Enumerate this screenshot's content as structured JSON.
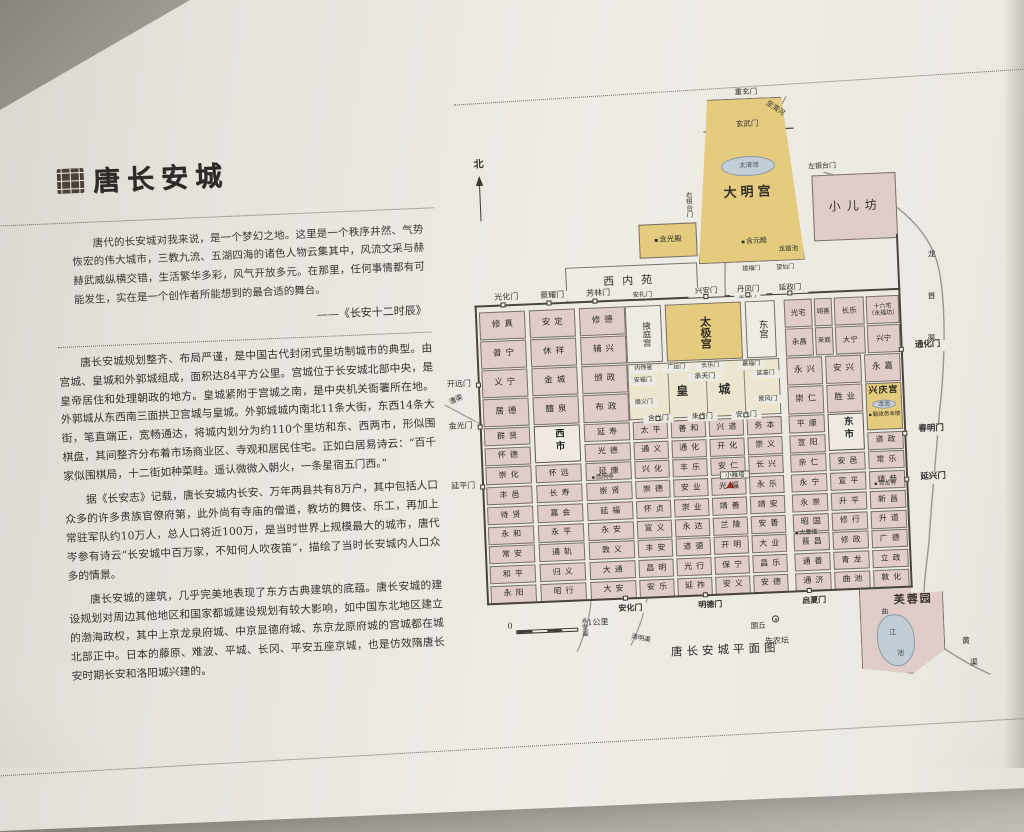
{
  "panel": {
    "title": "唐长安城",
    "quote": "唐代的长安城对我来说，是一个梦幻之地。这里是一个秩序井然、气势恢宏的伟大城市，三教九流、五湖四海的诸色人物云集其中，风流文采与赫赫武威纵横交错，生活繁华多彩，风气开放多元。在那里，任何事情都有可能发生，实在是一个创作者所能想到的最合适的舞台。",
    "attribution": "——《长安十二时辰》",
    "paragraphs": [
      "唐长安城规划整齐、布局严谨，是中国古代封闭式里坊制城市的典型。由宫城、皇城和外郭城组成，面积达84平方公里。宫城位于长安城北部中央，是皇帝居住和处理朝政的地方。皇城紧附于宫城之南，是中央机关衙署所在地。外郭城从东西南三面拱卫宫城与皇城。外郭城城内南北11条大街，东西14条大街，笔直端正，宽畅通达，将城内划分为约110个里坊和东、西两市，形似围棋盘，其间整齐分布着市场商业区、寺观和居民住宅。正如白居易诗云：“百千家似围棋局，十二街如种菜畦。遥认微微入朝火，一条星宿五门西。”",
      "据《长安志》记载，唐长安城内长安、万年两县共有8万户，其中包括人口众多的许多贵族官僚府第，此外尚有寺庙的僧道，教坊的舞伎、乐工，再加上常驻军队约10万人，总人口将近100万，是当时世界上规模最大的城市，唐代岑参有诗云“长安城中百万家，不知何人吹夜笛”，描绘了当时长安城内人口众多的情景。",
      "唐长安城的建筑，几乎完美地表现了东方古典建筑的底蕴。唐长安城的建设规划对周边其他地区和国家都城建设规划有较大影响，如中国东北地区建立的渤海政权，其中上京龙泉府城、中京显德府城、东京龙原府城的宫城都在城北部正中。日本的藤原、难波、平城、长冈、平安五座京城，也是仿效隋唐长安时期长安和洛阳城兴建的。"
    ]
  },
  "map": {
    "caption": "唐长安城平面图",
    "compass": "北",
    "scale": {
      "zero": "0",
      "unit": "1公里"
    },
    "palaces": {
      "daminggong": "大明宫",
      "xineiyuan": "西内苑",
      "yetinggong": "掖庭宫",
      "taijigong": "太极宫",
      "donggong": "东宫",
      "huangcheng": "皇城",
      "xingqinggong": "兴庆宫",
      "hanguangdian": "含光殿",
      "hanyuandian": "含元殿",
      "qinzheng": "勤政务本楼",
      "furongyuan": "芙蓉园"
    },
    "water": {
      "taiye": "太液池",
      "longshouchi": "龙首池",
      "longchi": "龙池",
      "qujiang_chars": [
        "曲",
        "江",
        "池"
      ],
      "zhiweihe": "至渭河"
    },
    "canals": {
      "caoqu": "漕渠",
      "yongan": "永安渠",
      "qingming": "清明渠",
      "longshou_chars": [
        "龙",
        "首",
        "渠"
      ],
      "huang_chars": [
        "黄",
        "渠"
      ]
    },
    "gates": {
      "guanghua": "光化门",
      "jingyao": "景耀门",
      "fanglin": "芳林门",
      "xingan": "兴安门",
      "danfeng": "丹凤门",
      "yanzheng": "延政门",
      "chongxuan": "重玄门",
      "xuanwu_dm": "玄武门",
      "zuoyintai": "左银台门",
      "youyintai": "右银台门",
      "xuanwu_xny": "玄武门",
      "anli": "安礼门",
      "kaiyuan": "开远门",
      "jinguang": "金光门",
      "yanping": "延平门",
      "tonghua": "通化门",
      "chunming": "春明门",
      "yanxing": "延兴门",
      "anhua": "安化门",
      "mingde": "明德门",
      "qixia": "启夏门",
      "chengtian": "承天门",
      "guangyun": "广运门",
      "changle_gate": "长乐门",
      "neishisheng": "内侍省",
      "jiafu": "嘉福门",
      "yanxi": "延喜门",
      "anfu": "安福门",
      "shunyi": "顺义门",
      "jingfeng": "景风门",
      "hanguang": "含光门",
      "zhuque": "朱雀门",
      "anshang": "安上门",
      "zhide": "至德门",
      "jianfu": "建福门",
      "wangxian": "望仙门"
    },
    "landmarks": {
      "yuanqiu": "圜丘",
      "xiannongtan": "先农坛",
      "xiaoyanta": "小雁塔",
      "dayanta": "大雁塔",
      "ximingsi": "西明寺",
      "qinglongsi": "青龙寺",
      "xiaoerfang": "小儿坊"
    },
    "markets": {
      "west": "西市",
      "east": "东市"
    },
    "ne_rows": [
      [
        "光宅",
        "翊善",
        "长乐",
        "十六宅（永福坊）"
      ],
      [
        "永昌",
        "来庭",
        "大宁",
        "兴宁"
      ]
    ],
    "west_rows": [
      [
        "修真",
        "安定",
        "修德"
      ],
      [
        "普宁",
        "休祥",
        "辅兴"
      ],
      [
        "义宁",
        "金城",
        "颁政"
      ],
      [
        "居德",
        "醴泉",
        "布政"
      ],
      [
        "群贤",
        "西市",
        "延寿"
      ],
      [
        "怀德",
        "",
        "光德"
      ],
      [
        "崇化",
        "怀远",
        "延康"
      ],
      [
        "丰邑",
        "长寿",
        "崇贤"
      ],
      [
        "待贤",
        "嘉会",
        "延福"
      ],
      [
        "永和",
        "永平",
        "永安"
      ],
      [
        "常安",
        "通轨",
        "敦义"
      ],
      [
        "和平",
        "归义",
        "大通"
      ],
      [
        "永阳",
        "昭行",
        "大安"
      ]
    ],
    "center_rows": [
      [
        "太平",
        "善和",
        "兴道",
        "务本"
      ],
      [
        "通义",
        "通化",
        "开化",
        "崇义"
      ],
      [
        "兴化",
        "丰乐",
        "安仁",
        "长兴"
      ],
      [
        "崇德",
        "安业",
        "光福",
        "永乐"
      ],
      [
        "怀贞",
        "崇业",
        "靖善",
        "靖安"
      ],
      [
        "宣义",
        "永达",
        "兰陵",
        "安善"
      ],
      [
        "丰安",
        "道德",
        "开明",
        "大业"
      ],
      [
        "昌明",
        "光行",
        "保宁",
        "昌乐"
      ],
      [
        "安乐",
        "延祚",
        "安义",
        "安德"
      ]
    ],
    "east_cols": {
      "c1": [
        "永兴",
        "崇仁",
        "平康",
        "宣阳",
        "亲仁",
        "永宁",
        "永崇",
        "昭国",
        "晋昌",
        "通善",
        "通济"
      ],
      "c2": [
        "安兴",
        "胜业",
        "东市",
        "安邑",
        "宣平",
        "升平",
        "修行",
        "修政",
        "青龙",
        "曲池"
      ],
      "c3": [
        "永嘉",
        "兴庆宫",
        "道政",
        "常乐",
        "靖恭",
        "新昌",
        "升道",
        "广德",
        "立政",
        "敦化"
      ]
    }
  }
}
